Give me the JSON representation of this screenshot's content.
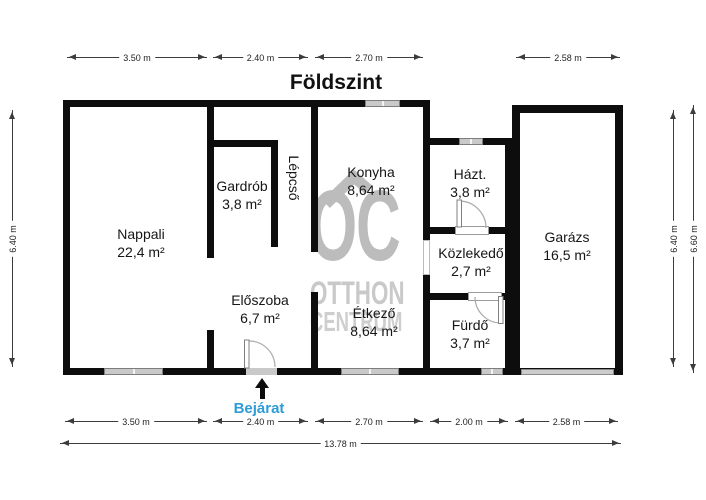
{
  "title": "Földszint",
  "watermark": {
    "logo": "OC",
    "line1": "OTTHON",
    "line2": "CENTRUM"
  },
  "entrance": {
    "label": "Bejárat"
  },
  "rooms": [
    {
      "id": "nappali",
      "name": "Nappali",
      "area": "22,4 m²"
    },
    {
      "id": "gardrob",
      "name": "Gardrób",
      "area": "3,8 m²"
    },
    {
      "id": "lepcso",
      "name": "Lépcső",
      "area": ""
    },
    {
      "id": "konyha",
      "name": "Konyha",
      "area": "8,64 m²"
    },
    {
      "id": "hazt",
      "name": "Házt.",
      "area": "3,8 m²"
    },
    {
      "id": "kozlekedo",
      "name": "Közlekedő",
      "area": "2,7 m²"
    },
    {
      "id": "garazs",
      "name": "Garázs",
      "area": "16,5 m²"
    },
    {
      "id": "eloszoba",
      "name": "Előszoba",
      "area": "6,7 m²"
    },
    {
      "id": "etkezo",
      "name": "Étkező",
      "area": "8,64 m²"
    },
    {
      "id": "furdo",
      "name": "Fürdő",
      "area": "3,7 m²"
    }
  ],
  "dimensions": {
    "top": [
      "3.50 m",
      "2.40 m",
      "2.70 m",
      "2.58 m"
    ],
    "bottom": [
      "3.50 m",
      "2.40 m",
      "2.70 m",
      "2.00 m",
      "2.58 m"
    ],
    "total": "13.78 m",
    "left": "6.40 m",
    "right_inner": "6.40 m",
    "right_outer": "6.60 m"
  },
  "colors": {
    "wall": "#0d0d0d",
    "window": "#c9c9c9",
    "watermark": "#bcbcbc",
    "entrance_blue": "#2E9CD6"
  }
}
